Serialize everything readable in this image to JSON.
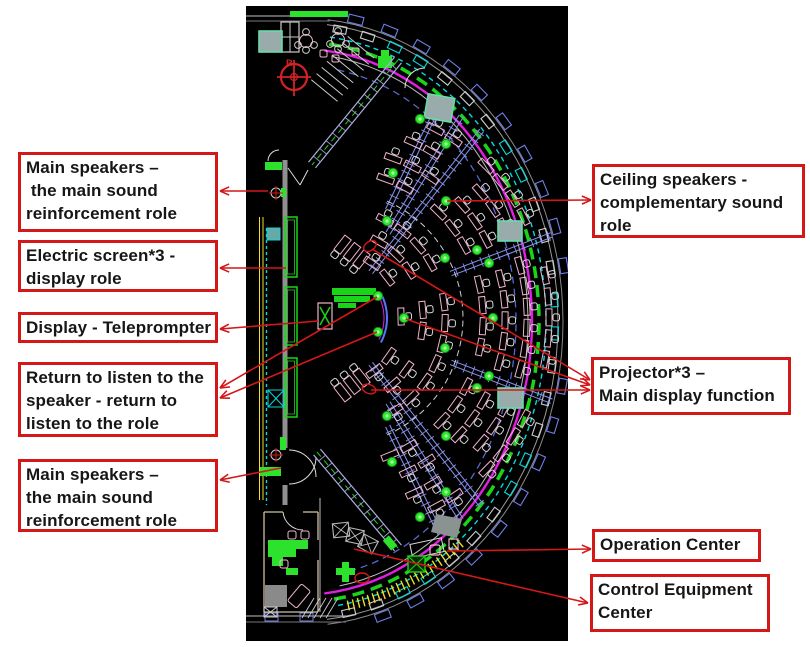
{
  "page": {
    "background": "#ffffff"
  },
  "annotations": {
    "accent_red": "#d41717",
    "left": [
      {
        "id": "main-speakers-top",
        "lines": [
          "Main speakers –",
          " the main sound",
          "reinforcement role"
        ]
      },
      {
        "id": "electric-screen",
        "lines": [
          "Electric screen*3 -",
          "display role"
        ]
      },
      {
        "id": "display-teleprompter",
        "lines": [
          "Display - Teleprompter"
        ]
      },
      {
        "id": "return-listen",
        "lines": [
          "Return to listen to the",
          "speaker - return to",
          "listen to the role"
        ]
      },
      {
        "id": "main-speakers-bottom",
        "lines": [
          "Main speakers –",
          "the main sound",
          "reinforcement role"
        ]
      }
    ],
    "right": [
      {
        "id": "ceiling-speakers",
        "lines": [
          "Ceiling speakers -",
          "complementary sound",
          "role"
        ]
      },
      {
        "id": "projector",
        "lines": [
          "Projector*3 –",
          "Main display function"
        ]
      },
      {
        "id": "operation-center",
        "lines": [
          "Operation Center"
        ]
      },
      {
        "id": "control-equipment",
        "lines": [
          "Control Equipment",
          "Center"
        ]
      }
    ],
    "arrows": [
      {
        "label": "main-speakers-top",
        "from": [
          268,
          191
        ],
        "to": [
          220,
          191
        ]
      },
      {
        "label": "electric-screen",
        "from": [
          286,
          268
        ],
        "to": [
          220,
          268
        ]
      },
      {
        "label": "display-teleprompter",
        "from": [
          318,
          321
        ],
        "to": [
          220,
          329
        ]
      },
      {
        "label": "return-listen",
        "from": [
          377,
          297
        ],
        "to": [
          220,
          388
        ]
      },
      {
        "label": "return-listen",
        "from": [
          377,
          332
        ],
        "to": [
          220,
          398
        ]
      },
      {
        "label": "main-speakers-bottom",
        "from": [
          281,
          468
        ],
        "to": [
          220,
          480
        ]
      },
      {
        "label": "ceiling-speakers",
        "from": [
          447,
          201
        ],
        "to": [
          591,
          200
        ]
      },
      {
        "label": "projector",
        "from": [
          372,
          249
        ],
        "to": [
          590,
          380
        ]
      },
      {
        "label": "projector",
        "from": [
          406,
          319
        ],
        "to": [
          590,
          385
        ]
      },
      {
        "label": "projector",
        "from": [
          371,
          390
        ],
        "to": [
          590,
          390
        ]
      },
      {
        "label": "operation-center",
        "from": [
          447,
          551
        ],
        "to": [
          591,
          549
        ]
      },
      {
        "label": "control-equipment",
        "from": [
          354,
          549
        ],
        "to": [
          588,
          603
        ]
      }
    ],
    "highlight_ellipses": [
      [
        370,
        246,
        7,
        4.5,
        -35
      ],
      [
        369,
        389,
        7,
        4.5,
        20
      ],
      [
        362,
        578,
        7,
        5,
        0
      ]
    ]
  },
  "floorplan": {
    "background": "#000000",
    "compass_letter": "R",
    "colors": {
      "cyan": "#00dcdc",
      "magenta": "#e020e0",
      "green": "#1ad41a",
      "bright_green": "#2ce22c",
      "yellow": "#f0e020",
      "pink": "#f0b4cc",
      "white": "#d8d8d8",
      "gray": "#909090",
      "blue": "#6673e0",
      "steel": "#8893ee",
      "red": "#d41717",
      "square_fill": "#9aabab",
      "square_stroke": "#66ddaa",
      "chair": "#d8d8d8"
    },
    "green_dots": [
      [
        420,
        119
      ],
      [
        446,
        144
      ],
      [
        393,
        173
      ],
      [
        446,
        201
      ],
      [
        387,
        221
      ],
      [
        477,
        250
      ],
      [
        445,
        258
      ],
      [
        489,
        263
      ],
      [
        493,
        318
      ],
      [
        404,
        318
      ],
      [
        378,
        296
      ],
      [
        378,
        332
      ],
      [
        445,
        348
      ],
      [
        489,
        376
      ],
      [
        477,
        388
      ],
      [
        387,
        416
      ],
      [
        446,
        436
      ],
      [
        392,
        462
      ],
      [
        446,
        492
      ],
      [
        420,
        517
      ]
    ],
    "gray_squares": [
      [
        426,
        96,
        27,
        24,
        10
      ],
      [
        498,
        221,
        24,
        20,
        0
      ],
      [
        498,
        388,
        25,
        20,
        0
      ],
      [
        259,
        31,
        23,
        21,
        0
      ]
    ],
    "wall_screens": [
      [
        285,
        217,
        12,
        60
      ],
      [
        285,
        287,
        12,
        58
      ],
      [
        285,
        358,
        12,
        59
      ]
    ],
    "wall_speakers": [
      [
        265,
        162,
        17,
        8
      ],
      [
        260,
        467,
        21,
        9
      ]
    ],
    "crosshair_markers": [
      [
        276,
        193
      ],
      [
        276,
        455
      ]
    ],
    "seating_rows": [
      {
        "r": 66,
        "a0": -56,
        "a1": 56,
        "aisles": [
          -19,
          19
        ],
        "hw": 6
      },
      {
        "r": 88,
        "a0": -60,
        "a1": 60,
        "aisles": [
          -19,
          19
        ],
        "hw": 5
      },
      {
        "r": 110,
        "a0": -63,
        "a1": 63,
        "aisles": [
          -19,
          19
        ],
        "hw": 4.5
      },
      {
        "r": 148,
        "a0": -70,
        "a1": 70,
        "aisles": [
          -21,
          21,
          -52,
          52
        ],
        "hw": 4.5
      },
      {
        "r": 170,
        "a0": -70,
        "a1": 70,
        "aisles": [
          -21,
          21,
          -51,
          51
        ],
        "hw": 4
      },
      {
        "r": 192,
        "a0": -66,
        "a1": 66,
        "aisles": [
          -21,
          21,
          -50,
          50
        ],
        "hw": 4
      },
      {
        "r": 214,
        "a0": -62,
        "a1": 62,
        "aisles": [
          -20,
          20,
          -49,
          49
        ],
        "hw": 3.5
      }
    ],
    "aisle_lines": [
      [
        -21,
        124,
        232
      ],
      [
        21,
        124,
        232
      ],
      [
        -52,
        58,
        238
      ],
      [
        52,
        58,
        238
      ],
      [
        -58,
        100,
        238
      ],
      [
        58,
        100,
        238
      ],
      [
        -64,
        120,
        240
      ],
      [
        64,
        120,
        240
      ]
    ]
  }
}
